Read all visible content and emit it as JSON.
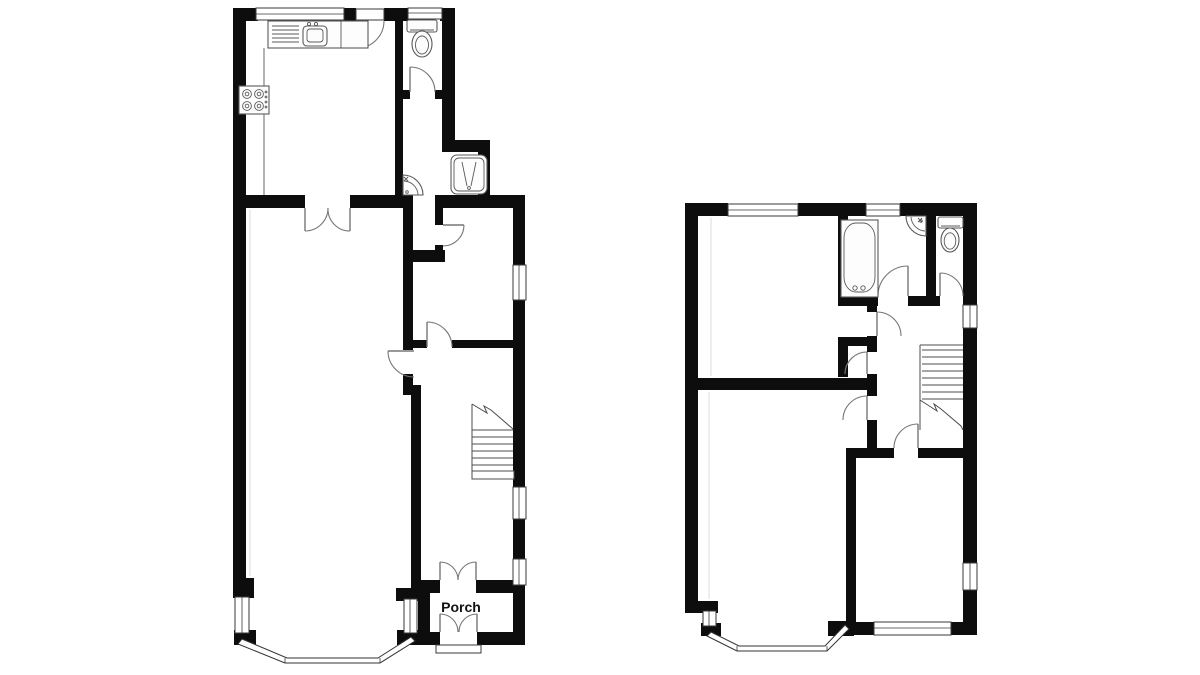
{
  "document": {
    "type": "floor-plan",
    "floor_count": 2,
    "floors": [
      {
        "id": "ground-floor",
        "rooms": [
          "kitchen",
          "wc",
          "shower-lobby",
          "reception-room",
          "living-room",
          "hall",
          "porch"
        ],
        "fixtures": [
          "kitchen-sink",
          "hob",
          "toilet",
          "corner-basin",
          "shower-cubicle",
          "staircase",
          "bay-window"
        ]
      },
      {
        "id": "first-floor",
        "rooms": [
          "bedroom-rear",
          "bathroom",
          "wc",
          "landing",
          "cupboard",
          "bedroom-front",
          "bedroom-right"
        ],
        "fixtures": [
          "bathtub",
          "corner-basin",
          "toilet",
          "staircase",
          "bay-window"
        ]
      }
    ]
  },
  "labels": {
    "porch": "Porch"
  },
  "colors": {
    "wall": "#0d0d0d",
    "background": "#ffffff",
    "window_stroke": "#3a3a3a",
    "fixture_stroke": "#5a5a5a",
    "door_arc": "#767676"
  }
}
